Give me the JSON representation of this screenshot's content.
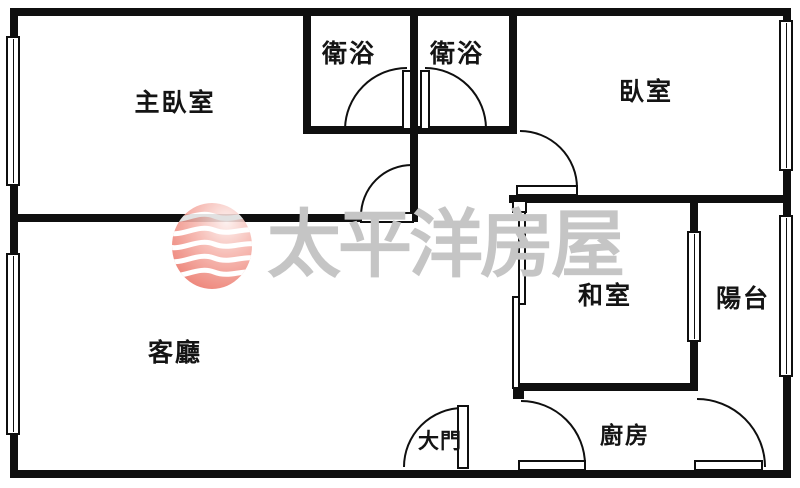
{
  "plan": {
    "type": "apartment-floor-plan",
    "background_color": "#ffffff",
    "wall_color": "#0f0f0f",
    "rooms": [
      {
        "name": "master-bedroom",
        "label": "主臥室"
      },
      {
        "name": "bathroom-1",
        "label": "衛浴"
      },
      {
        "name": "bathroom-2",
        "label": "衛浴"
      },
      {
        "name": "bedroom",
        "label": "臥室"
      },
      {
        "name": "tatami-room",
        "label": "和室"
      },
      {
        "name": "balcony",
        "label": "陽台"
      },
      {
        "name": "living-room",
        "label": "客廳"
      },
      {
        "name": "main-entrance",
        "label": "大門"
      },
      {
        "name": "kitchen",
        "label": "廚房"
      }
    ]
  },
  "watermark": {
    "text": "太平洋房屋",
    "text_color": "#c5c5c5",
    "logo_body_color": "#ee8176",
    "logo_wave_color": "#ffffff"
  }
}
